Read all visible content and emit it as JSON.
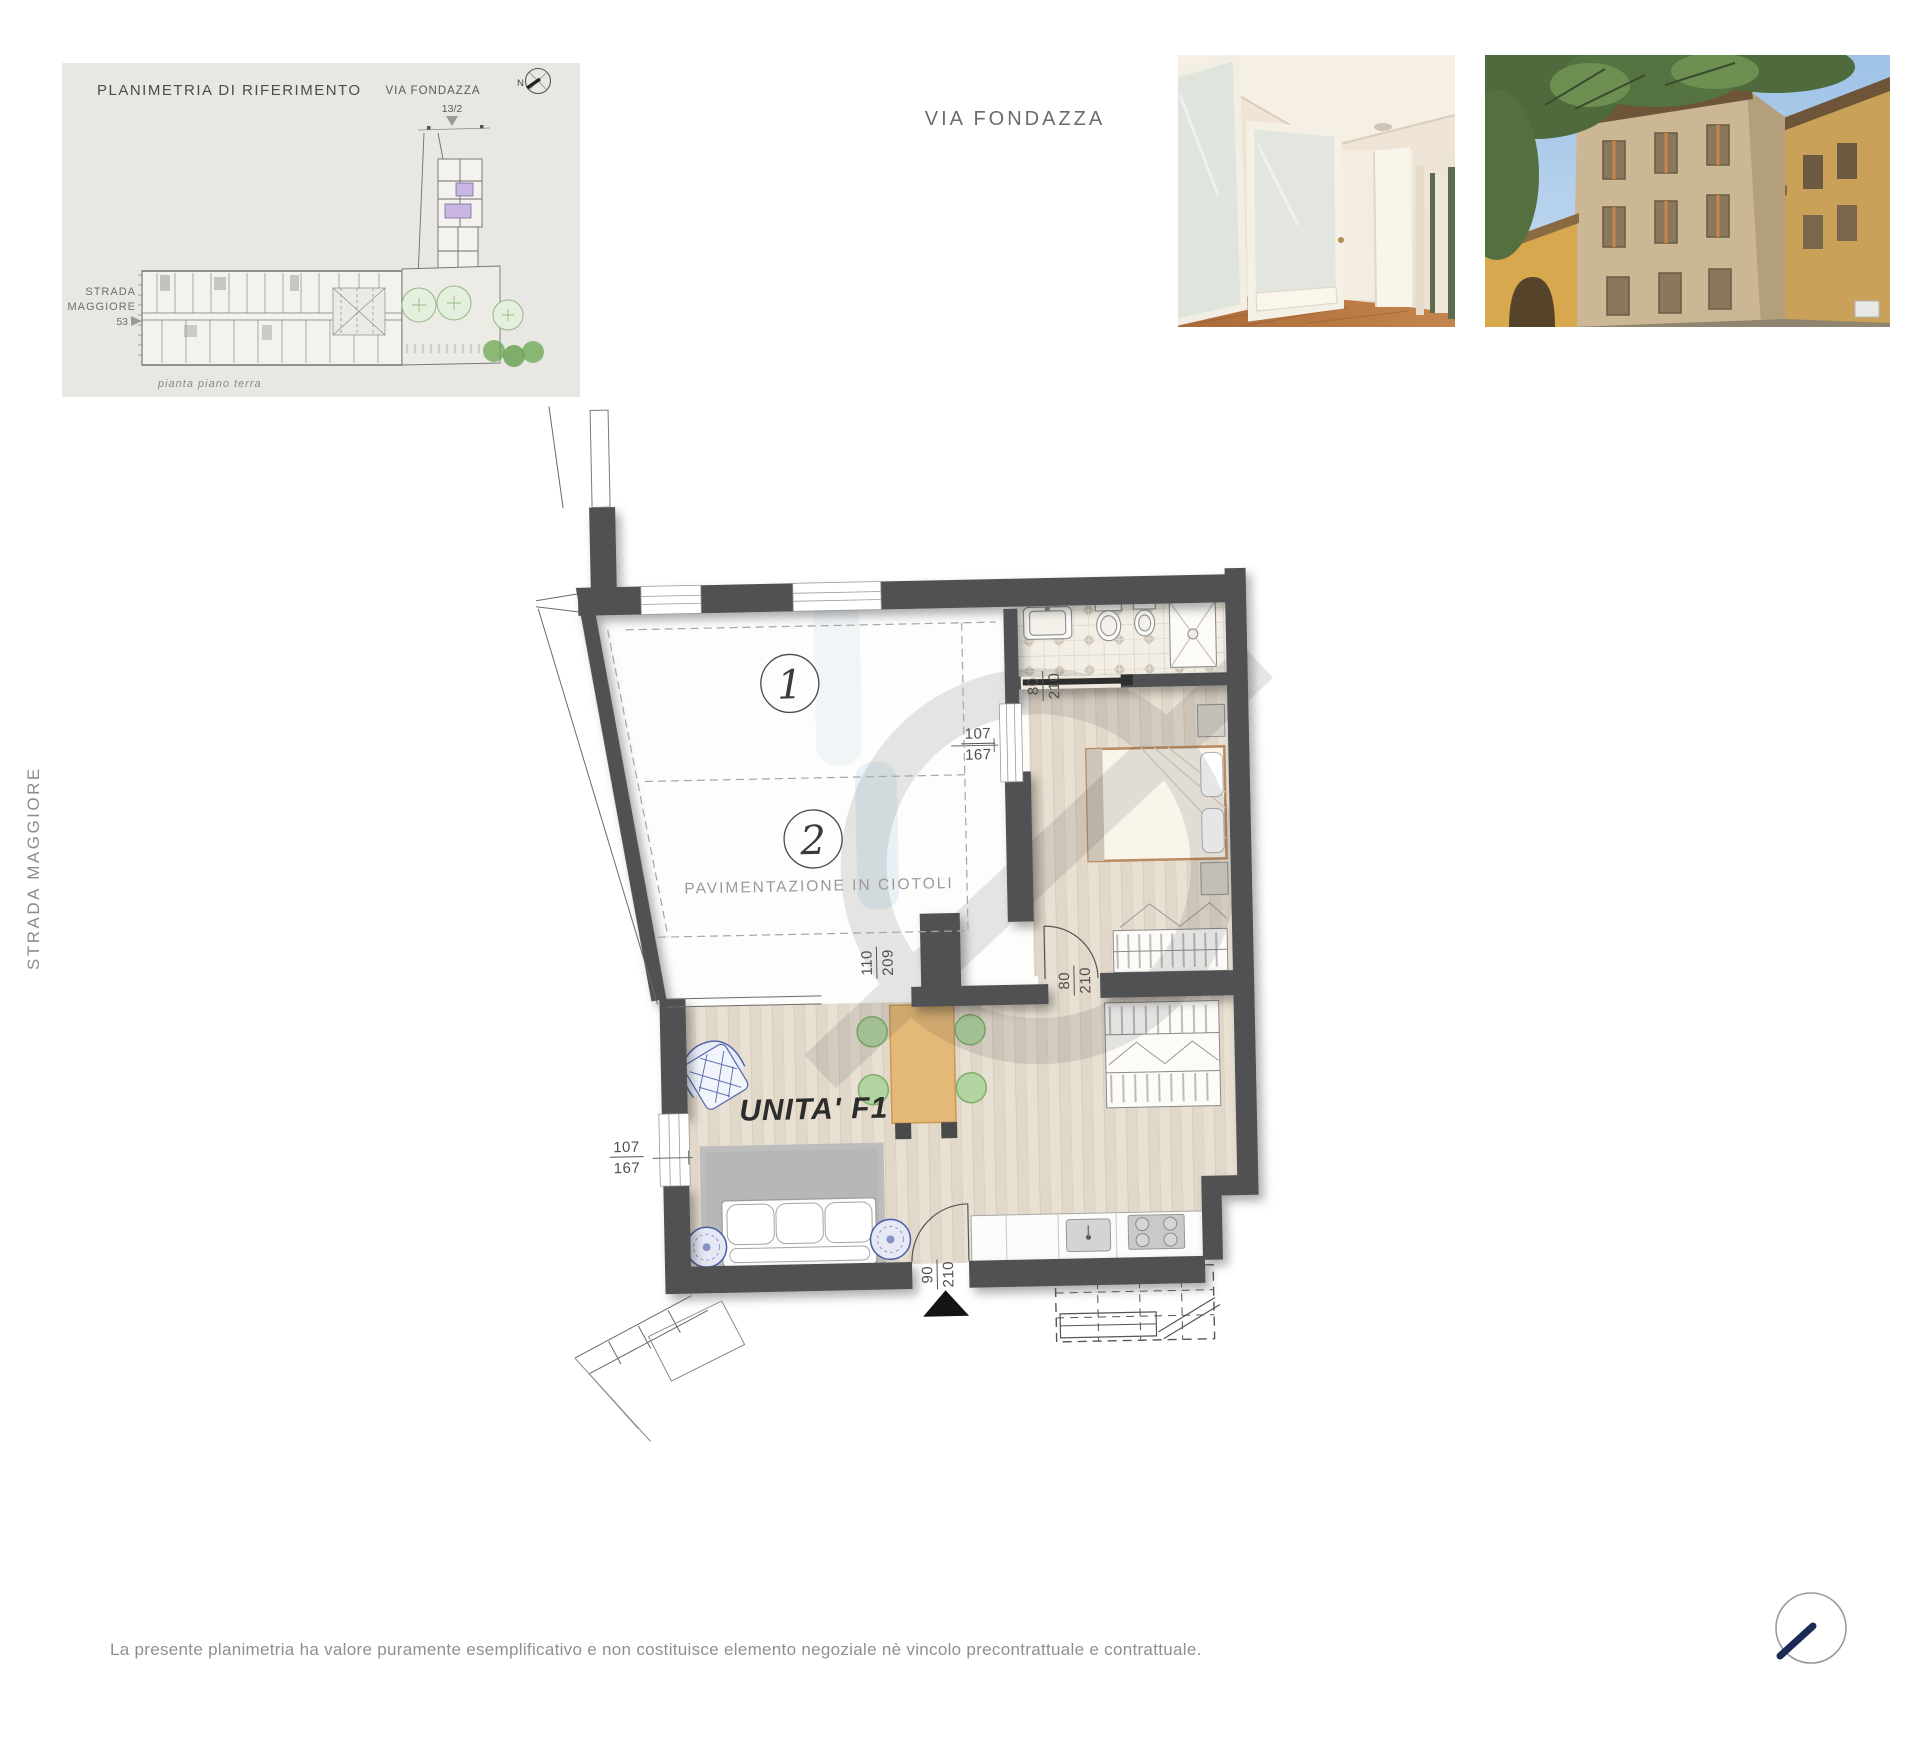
{
  "reference_panel": {
    "title": "PLANIMETRIA DI RIFERIMENTO",
    "street_top_label": "VIA FONDAZZA",
    "street_top_number": "13/2",
    "compass_north": "N",
    "street_left_line1": "STRADA",
    "street_left_line2": "MAGGIORE",
    "street_left_number": "53",
    "caption": "pianta piano terra"
  },
  "header": {
    "location_title": "VIA FONDAZZA"
  },
  "left_margin": {
    "street_label": "STRADA MAGGIORE"
  },
  "floor_plan": {
    "unit_label": "UNITA' F1",
    "zone1_number": "1",
    "zone2_number": "2",
    "paving_label": "PAVIMENTAZIONE IN CIOTOLI",
    "dims": {
      "window_right": {
        "num": "107",
        "den": "167"
      },
      "bath_door": {
        "num": "80",
        "den": "210"
      },
      "court_opening": {
        "num": "110",
        "den": "209"
      },
      "bed_door": {
        "num": "80",
        "den": "210"
      },
      "window_left": {
        "num": "107",
        "den": "167"
      },
      "entrance_door": {
        "num": "90",
        "den": "210"
      }
    }
  },
  "footer": {
    "disclaimer": "La presente planimetria ha valore puramente esemplificativo e non costituisce elemento negoziale nè vincolo precontrattuale e contrattuale."
  },
  "colors": {
    "wall": "#515153",
    "accent_navy": "#1e2a56",
    "unit_highlight_purple": "#c9b6e4",
    "tree_green": "#6aa84f",
    "wood_floor": "#e8e0d3"
  }
}
